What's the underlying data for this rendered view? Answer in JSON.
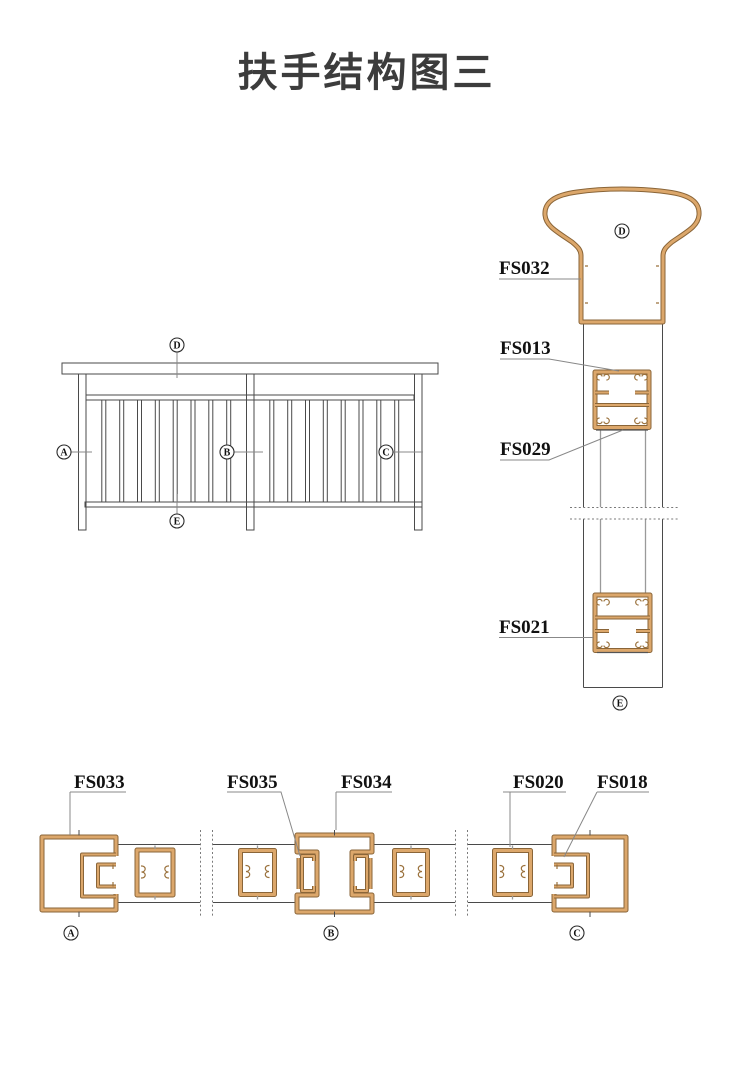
{
  "title": "扶手结构图三",
  "colors": {
    "profile_fill": "#DCA76B",
    "profile_edge": "#8A6538",
    "drawing_line": "#4A4A4A",
    "leader_line": "#888888",
    "text": "#111111"
  },
  "parts": {
    "fs032": "FS032",
    "fs013": "FS013",
    "fs029": "FS029",
    "fs021": "FS021",
    "fs033": "FS033",
    "fs035": "FS035",
    "fs034": "FS034",
    "fs020": "FS020",
    "fs018": "FS018"
  },
  "markers": {
    "a": "A",
    "b": "B",
    "c": "C",
    "d": "D",
    "e": "E"
  }
}
